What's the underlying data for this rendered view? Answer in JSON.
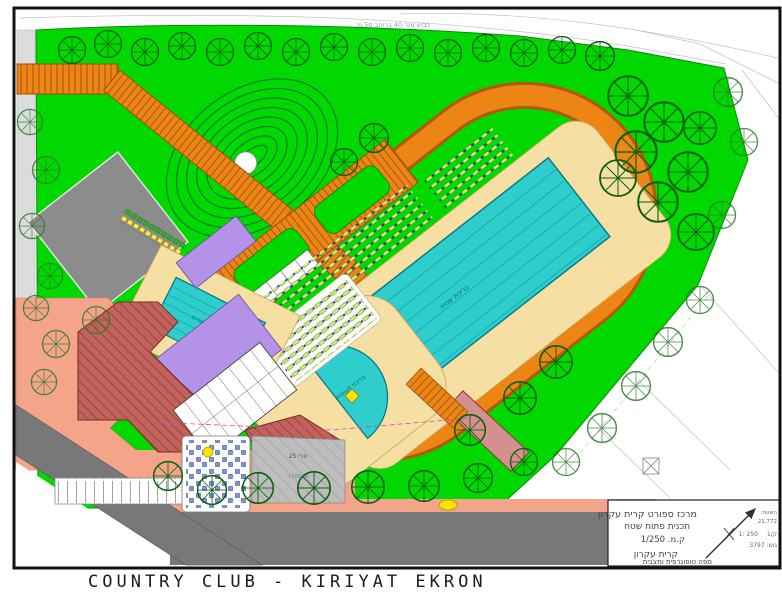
{
  "caption": "COUNTRY CLUB - KIRIYAT EKRON",
  "road_label": "כביש מס' 40 ברוחב 50 מ'",
  "plan_labels": {
    "main_pool": "בריכת שחיה",
    "training_pool": "בריכה לימודית",
    "kids_pool": "בריכת פעוטות",
    "parking_count": "חני' 25",
    "elevation": "+100.00"
  },
  "title_block": {
    "project_line1": "מרכז ספורט קרית עקרון",
    "project_line2": "תכנית פתוח שטח",
    "scale_line": "ק.מ.  1/250",
    "city": "קרית עקרון",
    "map_type": "מפה טופוגרפית ומצבית",
    "area_label": "השטח:",
    "area_value": "21,772",
    "scale_small": "1: 250",
    "sheet": "ק/1",
    "block_parcel": "גוש: 3797"
  },
  "colors": {
    "lawn": "#00d800",
    "track": "#ed8514",
    "track_dark": "#b35708",
    "water": "#2fcecc",
    "deck": "#f6dfa2",
    "building_red": "#c1625c",
    "building_purple": "#b492e8",
    "plaza_salmon": "#f4a488",
    "road": "#787878",
    "parking_gray": "#bdbdbd",
    "bldg_gray": "#8c8c8c"
  }
}
